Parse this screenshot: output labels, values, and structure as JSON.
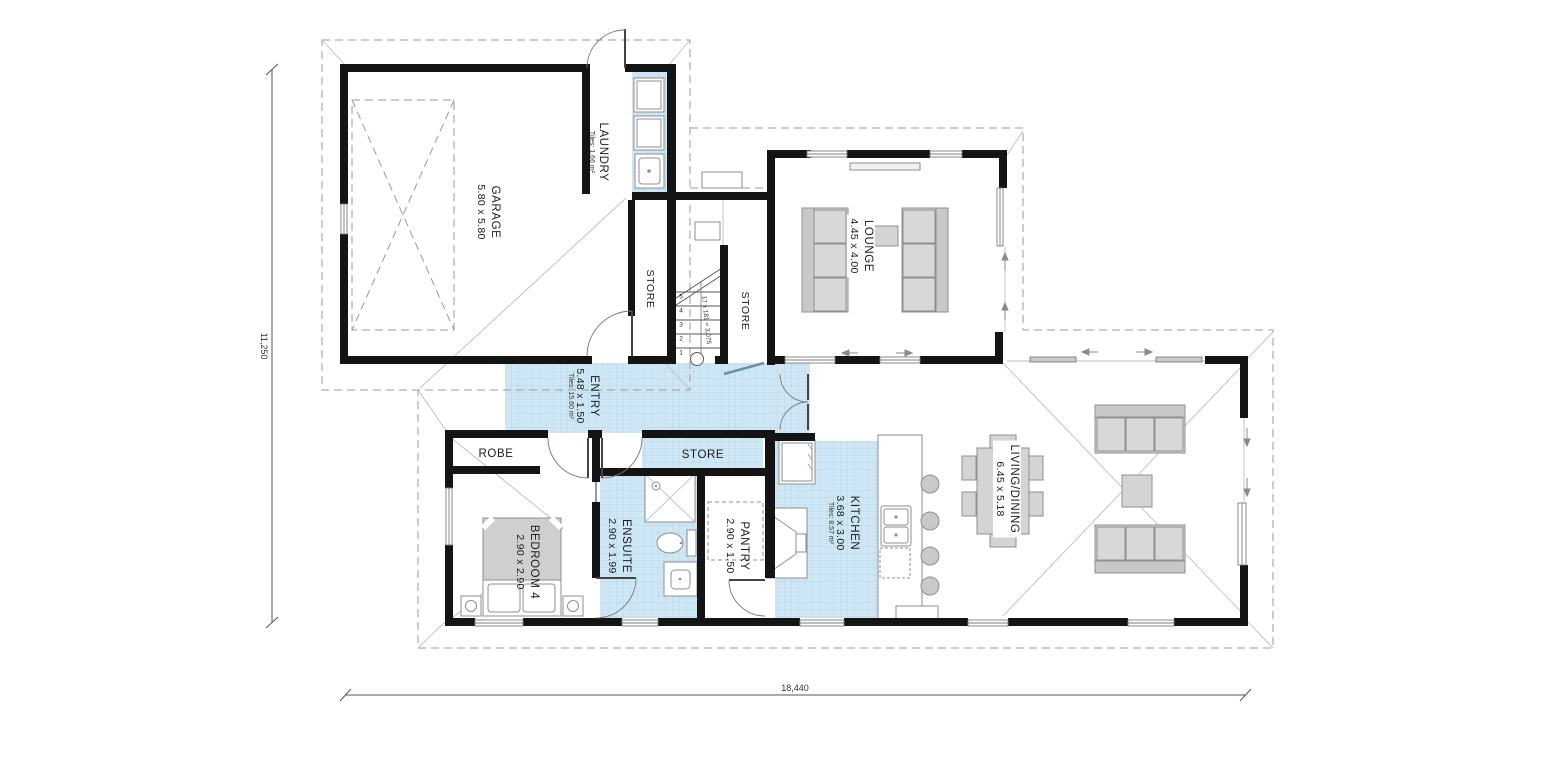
{
  "title": "floor-plan",
  "rooms": {
    "garage": {
      "name": "GARAGE",
      "dims": "5.80 x 5.80"
    },
    "laundry": {
      "name": "LAUNDRY",
      "tiles": "Tiles: 1.66 m²"
    },
    "store_hall": {
      "name": "STORE"
    },
    "store_stairs": {
      "name": "STORE"
    },
    "store_entry": {
      "name": "STORE"
    },
    "lounge": {
      "name": "LOUNGE",
      "dims": "4.45 x 4.00"
    },
    "entry": {
      "name": "ENTRY",
      "dims": "5.48 x 1.50",
      "tiles": "Tiles: 15.60 m²"
    },
    "robe": {
      "name": "ROBE"
    },
    "bedroom4": {
      "name": "BEDROOM 4",
      "dims": "2.90 x 2.90"
    },
    "ensuite": {
      "name": "ENSUITE",
      "dims": "2.90 x 1.99"
    },
    "pantry": {
      "name": "PANTRY",
      "dims": "2.90 x 1.50"
    },
    "kitchen": {
      "name": "KITCHEN",
      "dims": "3.68 x 3.00",
      "tiles": "Tiles: 8.57 m²"
    },
    "living": {
      "name": "LIVING/DINING",
      "dims": "6.45 x 5.18"
    }
  },
  "stairs": {
    "numbers": {
      "n1": "1",
      "n2": "2",
      "n3": "3",
      "n4": "4",
      "n5": "5"
    },
    "annotation": "17 x 181 = 3,075"
  },
  "dimensions": {
    "overall_width": "18,440",
    "overall_height": "11,250"
  },
  "colors": {
    "wall": "#141414",
    "tile_fill": "#cfe7f5",
    "tile_grid": "#b2d4e8",
    "furniture": "#d4d4d4",
    "furniture_stroke": "#8f8f8f",
    "dashed_line": "#9b9b9b",
    "window": "#7d7d7d"
  }
}
